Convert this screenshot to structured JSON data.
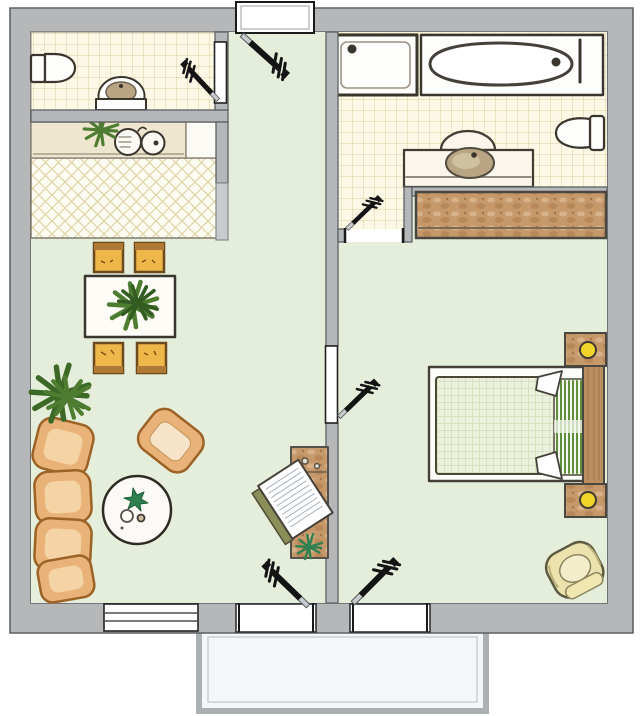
{
  "meta": {
    "type": "apartment floor plan",
    "style": "hand-drawn colored architectural sketch, top-down view",
    "width_px": 640,
    "height_px": 716,
    "text_labels": []
  },
  "palette": {
    "background": "#ffffff",
    "wall-fill": "#b5b7b9",
    "wall-light": "#c9cbcd",
    "wall-edge": "#5e6163",
    "floor-green": "#e5eeda",
    "tile-bg": "#fcf8e6",
    "tile-line": "#dbcf9d",
    "hatch-bg": "#fdfcf3",
    "hatch-line": "#e0d5a8",
    "counter-beige": "#efe6d0",
    "counter-white": "#fbfaf4",
    "wood-tan": "#c6996b",
    "wood-spot-light": "#d7b189",
    "wood-spot-dark": "#b9885a",
    "wood-edge": "#4a4742",
    "headboard": "#bb8f60",
    "sofa-orange": "#e9b278",
    "sofa-edge": "#9c6226",
    "cushion-light": "#f4d3a4",
    "chair-yellow": "#edb74a",
    "chair-frame": "#6d4a1e",
    "chair-back": "#b07a36",
    "duvet-bg": "#ecf1de",
    "duvet-line": "#d4e2c0",
    "stripe-green": "#5d8f3d",
    "lamp-yellow": "#f2d428",
    "khaki": "#ece2ae",
    "khaki-edge": "#5c5a40",
    "plant-green": "#4e7d32",
    "plant-dark": "#335c22",
    "star-green": "#2f8050",
    "door-black": "#141414",
    "hinge-gray": "#c8cbcd",
    "balcony-fill": "#f4f6f7",
    "balcony-edge": "#abb1b3",
    "balcony-inner": "#cbcfd1",
    "olive": "#8a8f5a",
    "sketch-dark": "#3a362e",
    "fixture-white": "#fdfdfb",
    "bowl-tan": "#b9a584",
    "bowl-edge": "#514c3f"
  },
  "legend": {
    "rooms": [
      {
        "name": "entrance-hall",
        "floor": "green",
        "openings": [
          "entrance-door"
        ]
      },
      {
        "name": "wc",
        "floor": "yellow-grid-tile",
        "fixtures": [
          "toilet",
          "hand-basin"
        ],
        "openings": [
          "wc-door"
        ]
      },
      {
        "name": "kitchen",
        "floor": "diagonal-lattice-tile",
        "fixtures": [
          "counter",
          "double-sink",
          "plant"
        ]
      },
      {
        "name": "living-room",
        "floor": "green",
        "furniture": [
          "dining-table-with-plant",
          "dining-chair x4",
          "sofa-cushions x4",
          "armchair",
          "round-coffee-table",
          "floor-plant",
          "desk-with-drawing-board"
        ],
        "openings": [
          "window",
          "balcony-door"
        ]
      },
      {
        "name": "bedroom",
        "floor": "green",
        "furniture": [
          "double-bed",
          "nightstand-with-lamp x2",
          "wardrobe",
          "armchair"
        ],
        "openings": [
          "bedroom-door",
          "balcony-door"
        ]
      },
      {
        "name": "bathroom",
        "floor": "yellow-grid-tile",
        "fixtures": [
          "shower",
          "bathtub",
          "toilet",
          "vanity-basin"
        ],
        "openings": [
          "bathroom-door"
        ]
      },
      {
        "name": "balcony",
        "floor": "light-gray"
      }
    ],
    "counts": {
      "door-swings": 6,
      "door-panels": 2,
      "windows": 1,
      "balconies": 1,
      "plants": 5
    }
  }
}
